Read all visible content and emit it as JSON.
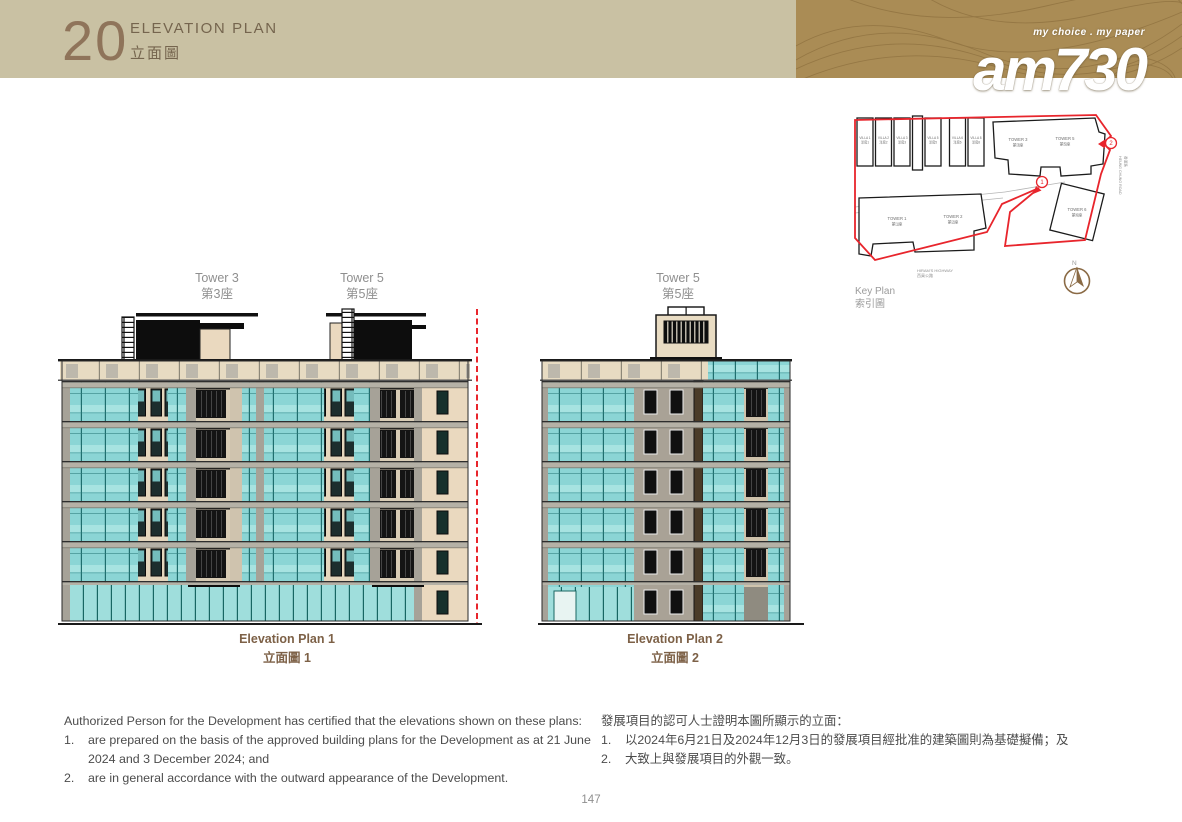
{
  "header": {
    "chapter": "20",
    "title_en": "ELEVATION PLAN",
    "title_zh": "立面圖"
  },
  "logo": {
    "tagline": "my choice . my paper",
    "brand": "am730"
  },
  "key_plan": {
    "title_en": "Key Plan",
    "title_zh": "索引圖",
    "north": "N",
    "villas": [
      {
        "en": "VILLA 1",
        "zh": "洋房1"
      },
      {
        "en": "VILLA 2",
        "zh": "洋房2"
      },
      {
        "en": "VILLA 3",
        "zh": "洋房3"
      },
      {
        "en": "VILLA 5",
        "zh": "洋房5"
      },
      {
        "en": "VILLA 6",
        "zh": "洋房6"
      },
      {
        "en": "VILLA 8",
        "zh": "洋房8"
      }
    ],
    "towers": [
      {
        "en": "TOWER 1",
        "zh": "第1座"
      },
      {
        "en": "TOWER 2",
        "zh": "第2座"
      },
      {
        "en": "TOWER 3",
        "zh": "第3座"
      },
      {
        "en": "TOWER 5",
        "zh": "第5座"
      },
      {
        "en": "TOWER 6",
        "zh": "第6座"
      }
    ],
    "roads": [
      {
        "en": "HIRAM'S HIGHWAY",
        "zh": "西貢公路"
      },
      {
        "en": "HEUNG CHUNG ROAD",
        "zh": "香涌路"
      }
    ],
    "markers": [
      {
        "num": "1"
      },
      {
        "num": "2"
      }
    ]
  },
  "plans": [
    {
      "towers": [
        {
          "en": "Tower 3",
          "zh": "第3座"
        },
        {
          "en": "Tower 5",
          "zh": "第5座"
        }
      ],
      "caption_en": "Elevation Plan 1",
      "caption_zh": "立面圖 1"
    },
    {
      "towers": [
        {
          "en": "Tower 5",
          "zh": "第5座"
        }
      ],
      "caption_en": "Elevation Plan 2",
      "caption_zh": "立面圖 2"
    }
  ],
  "notes_en": {
    "intro": "Authorized Person for the Development has certified that the elevations shown on these plans:",
    "items": [
      {
        "num": "1.",
        "text": "are prepared on the basis of the approved building plans for the Development as at 21 June 2024 and 3 December 2024; and"
      },
      {
        "num": "2.",
        "text": "are in general accordance with the outward appearance of the Development."
      }
    ]
  },
  "notes_zh": {
    "intro": "發展項目的認可人士證明本圖所顯示的立面：",
    "items": [
      {
        "num": "1.",
        "text": "以2024年6月21日及2024年12月3日的發展項目經批准的建築圖則為基礎擬備；及"
      },
      {
        "num": "2.",
        "text": "大致上與發展項目的外觀一致。"
      }
    ]
  },
  "page": {
    "number": "147"
  },
  "palette": {
    "header_beige": "#c9c1a3",
    "header_brown": "#aa8c55",
    "accent_brown": "#7d6147",
    "glass_teal": "#8bd5d5",
    "wall_beige": "#e9dcc2",
    "slab_gray": "#b5b1a6",
    "boundary_red": "#e8252c",
    "label_gray": "#8f8f8f"
  }
}
